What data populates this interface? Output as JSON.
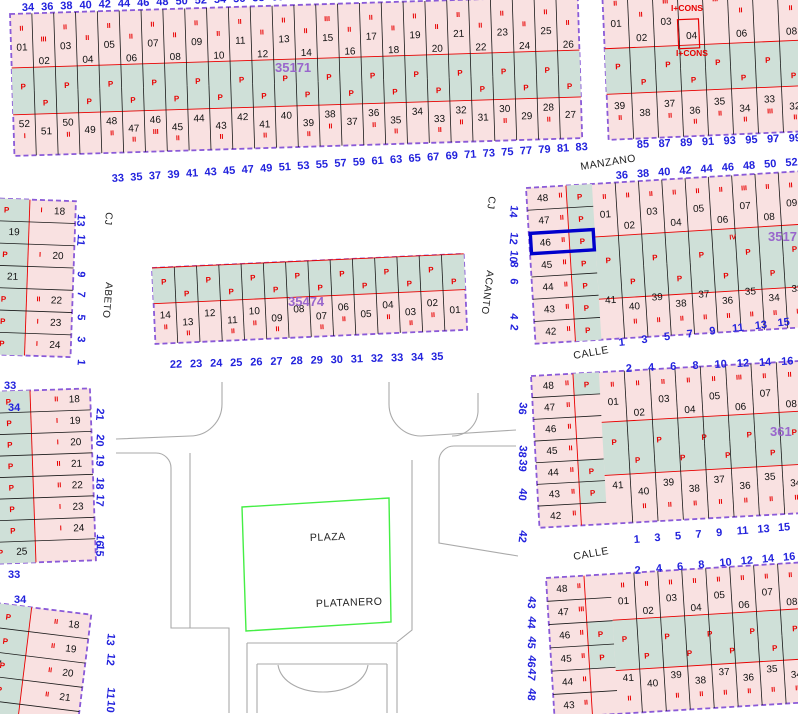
{
  "map": {
    "p_symbol": "P",
    "colors": {
      "parcel_fill": "#f9e1e1",
      "green_fill": "#cfe0d8",
      "block_border": "#8a5ad8",
      "parcel_line": "#1a1a1a",
      "red": "#e80000",
      "blue_number": "#2222dd",
      "purple_label": "#9966cc",
      "selected": "#0000cc",
      "plaza_green": "#44ee44",
      "street_gray": "#aaaaaa"
    },
    "selected_parcel": "46",
    "street_names": [
      {
        "text": "MANZANO",
        "x": 581,
        "y": 170,
        "rot": -9,
        "size": 10.5
      },
      {
        "text": "CALLE",
        "x": 574,
        "y": 359,
        "rot": -10,
        "size": 10.5
      },
      {
        "text": "CALLE",
        "x": 574,
        "y": 560,
        "rot": -10,
        "size": 10.5
      },
      {
        "text": "CJ",
        "x": 489,
        "y": 196,
        "rot": 97,
        "size": 10
      },
      {
        "text": "ACANTO",
        "x": 487,
        "y": 270,
        "rot": 97,
        "size": 10
      },
      {
        "text": "CJ",
        "x": 106,
        "y": 212,
        "rot": 95,
        "size": 10
      },
      {
        "text": "ABETO",
        "x": 106,
        "y": 282,
        "rot": 95,
        "size": 10
      },
      {
        "text": "PLAZA",
        "x": 310,
        "y": 541,
        "rot": -2,
        "size": 10.5
      },
      {
        "text": "PLATANERO",
        "x": 316,
        "y": 607,
        "rot": -2,
        "size": 10.5
      }
    ],
    "block_labels": [
      {
        "text": "35171",
        "x": 275,
        "y": 72
      },
      {
        "text": "35474",
        "x": 288,
        "y": 306
      },
      {
        "text": "3517",
        "x": 768,
        "y": 241
      },
      {
        "text": "361",
        "x": 770,
        "y": 436
      }
    ],
    "red_labels": [
      {
        "text": "I+CONS",
        "x": 671,
        "y": 11
      },
      {
        "text": "I+CONS",
        "x": 676,
        "y": 56
      }
    ],
    "stray_numbers": [
      {
        "t": "33",
        "x": 4,
        "y": 389
      },
      {
        "t": "34",
        "x": 8,
        "y": 411
      },
      {
        "t": "33",
        "x": 8,
        "y": 578
      },
      {
        "t": "34",
        "x": 14,
        "y": 603
      }
    ],
    "street_numbers": [
      {
        "id": "manzano-a-top",
        "vals": [
          "34",
          "36",
          "38",
          "40",
          "42",
          "44",
          "46",
          "48",
          "50",
          "52",
          "54",
          "56",
          "58",
          "60",
          "62"
        ],
        "x": 22,
        "y": 11,
        "dx": 19.2,
        "dy": -0.8,
        "rot": -2
      },
      {
        "id": "manzano-a-bottom",
        "vals": [
          "33",
          "35",
          "37",
          "39",
          "41",
          "43",
          "45",
          "47",
          "49",
          "51",
          "53",
          "55",
          "57",
          "59",
          "61",
          "63",
          "65",
          "67",
          "69",
          "71",
          "73",
          "75",
          "77",
          "79",
          "81",
          "83"
        ],
        "x": 112,
        "y": 182,
        "dx": 18.55,
        "dy": -1.25,
        "rot": -4
      },
      {
        "id": "manzano-b-bottom",
        "vals": [
          "85",
          "87",
          "89",
          "91",
          "93",
          "95",
          "97",
          "99"
        ],
        "x": 637,
        "y": 148,
        "dx": 21.7,
        "dy": -0.9,
        "rot": -3
      },
      {
        "id": "manzano-c-top",
        "vals": [
          "36",
          "38",
          "40",
          "42",
          "44",
          "46",
          "48",
          "50",
          "52"
        ],
        "x": 616,
        "y": 179,
        "dx": 21.2,
        "dy": -1.6,
        "rot": -4
      },
      {
        "id": "calle-c-bottom",
        "vals": [
          "1",
          "3",
          "5",
          "7",
          "9",
          "11",
          "13",
          "15"
        ],
        "x": 619,
        "y": 346,
        "dx": 22.7,
        "dy": -2.8,
        "rot": -6
      },
      {
        "id": "e-bottom",
        "vals": [
          "22",
          "23",
          "24",
          "25",
          "26",
          "27",
          "28",
          "29",
          "30",
          "31",
          "32",
          "33",
          "34",
          "35"
        ],
        "x": 170,
        "y": 368,
        "dx": 20.1,
        "dy": -0.6,
        "rot": -2
      },
      {
        "id": "acanto-vertical",
        "vals": [
          "14",
          "12",
          "10",
          "8",
          "6",
          "4",
          "2"
        ],
        "x": 511,
        "y": 205,
        "dys": [
          0,
          27,
          45,
          56,
          73,
          108,
          119
        ],
        "rot": 97
      },
      {
        "id": "abeto-vertical",
        "vals": [
          "13",
          "11",
          "9",
          "7",
          "5",
          "3",
          "1"
        ],
        "x": 78,
        "y": 214,
        "dys": [
          0,
          20,
          57,
          77,
          100,
          122,
          145
        ],
        "rot": 95
      },
      {
        "id": "f-right-vertical",
        "vals": [
          "21",
          "20",
          "19",
          "18",
          "17",
          "16",
          "15"
        ],
        "x": 97,
        "y": 408,
        "dys": [
          0,
          26,
          46,
          69,
          86,
          126,
          136
        ],
        "rot": 95
      },
      {
        "id": "g-right-vertical",
        "vals": [
          "13",
          "12",
          "11",
          "10"
        ],
        "x": 108,
        "y": 633,
        "dys": [
          0,
          20,
          54,
          67
        ],
        "rot": 97
      },
      {
        "id": "h-left-vertical",
        "vals": [
          "36",
          "38",
          "39",
          "40",
          "42"
        ],
        "x": 520,
        "y": 402,
        "dys": [
          0,
          43,
          57,
          86,
          128
        ],
        "rot": 97
      },
      {
        "id": "h-top",
        "vals": [
          "2",
          "4",
          "6",
          "8",
          "10",
          "12",
          "14",
          "16"
        ],
        "x": 626,
        "y": 372,
        "dx": 22.2,
        "dy": -1.0,
        "rot": -3
      },
      {
        "id": "h-bottom",
        "vals": [
          "1",
          "3",
          "5",
          "7",
          "9",
          "11",
          "13",
          "15"
        ],
        "x": 634,
        "y": 543,
        "dx": 20.6,
        "dy": -1.7,
        "rot": -4
      },
      {
        "id": "i-top",
        "vals": [
          "2",
          "4",
          "6",
          "8",
          "10",
          "12",
          "14",
          "16"
        ],
        "x": 635,
        "y": 574,
        "dx": 21.2,
        "dy": -1.9,
        "rot": -5
      },
      {
        "id": "i-left-vertical",
        "vals": [
          "43",
          "44",
          "45",
          "46",
          "47",
          "48"
        ],
        "x": 529,
        "y": 596,
        "dys": [
          0,
          20,
          40,
          59,
          72,
          92
        ],
        "rot": 97
      }
    ],
    "blocks": [
      {
        "id": "35171",
        "type": "h2",
        "x": 10,
        "y": 14,
        "w": 568,
        "h": 142,
        "rot": -1.8,
        "bandY": 0.38,
        "bandH": 0.33,
        "p_count": 26,
        "top": [
          "01",
          "02",
          "03",
          "04",
          "05",
          "06",
          "07",
          "08",
          "09",
          "10",
          "11",
          "12",
          "13",
          "14",
          "15",
          "16",
          "17",
          "18",
          "19",
          "20",
          "21",
          "22",
          "23",
          "24",
          "25",
          "26"
        ],
        "bottom": [
          "52",
          "51",
          "50",
          "49",
          "48",
          "47",
          "46",
          "45",
          "44",
          "43",
          "42",
          "41",
          "40",
          "39",
          "38",
          "37",
          "36",
          "35",
          "34",
          "33",
          "32",
          "31",
          "30",
          "29",
          "28",
          "27"
        ],
        "marks_top": [
          "II",
          "III",
          "II",
          "II",
          "II",
          "II",
          "II",
          "II",
          "II",
          "II",
          "II",
          "II",
          "II",
          "II",
          "III",
          "II",
          "II",
          "II",
          "II",
          "II",
          "II",
          "II",
          "II",
          "II",
          "II",
          "II"
        ],
        "marks_bottom": [
          "I",
          "",
          "II",
          "",
          "II",
          "II",
          "III",
          "II",
          "",
          "II",
          "",
          "II",
          "",
          "II",
          "II",
          "",
          "II",
          "II",
          "",
          "II",
          "II",
          "",
          "II",
          "",
          "II",
          ""
        ]
      },
      {
        "id": "manzano-north",
        "type": "h2",
        "x": 602,
        "y": -12,
        "w": 200,
        "h": 152,
        "rot": -2.5,
        "bandY": 0.4,
        "bandH": 0.3,
        "p_count": 8,
        "top": [
          "01",
          "02",
          "03",
          "04",
          "",
          "06",
          "",
          "08"
        ],
        "bottom": [
          "39",
          "38",
          "37",
          "36",
          "35",
          "34",
          "33",
          "32"
        ],
        "marks_top": [
          "II",
          "II",
          "III",
          "",
          "III",
          "II",
          "",
          "II"
        ],
        "marks_bottom": [
          "II",
          "",
          "II",
          "II",
          "II",
          "II",
          "III",
          "II"
        ],
        "red_box": [
          74,
          35,
          21,
          29
        ]
      },
      {
        "id": "3517",
        "type": "corner",
        "x": 526,
        "y": 188,
        "w": 276,
        "h": 156,
        "rot": -3.5,
        "leftW": 40,
        "greenColW": 26,
        "strip": "full",
        "selected_left": 2,
        "bandY": 0.34,
        "bandH": 0.4,
        "p_count": 9,
        "left": [
          "48",
          "47",
          "46",
          "45",
          "44",
          "43",
          "42"
        ],
        "top": [
          "01",
          "02",
          "03",
          "04",
          "05",
          "06",
          "07",
          "08",
          "09"
        ],
        "bottom": [
          "41",
          "40",
          "39",
          "38",
          "37",
          "36",
          "35",
          "34",
          "33"
        ],
        "marks_left": [
          "II",
          "II",
          "II",
          "II",
          "II",
          "II",
          "II"
        ],
        "marks_top": [
          "II",
          "II",
          "II",
          "II",
          "II",
          "II",
          "III",
          "II",
          "II"
        ],
        "marks_bottom": [
          "",
          "II",
          "II",
          "II",
          "II",
          "II",
          "II",
          "II",
          "II"
        ],
        "extra_marks": [
          {
            "t": "IV",
            "x": 200,
            "y": 64
          }
        ]
      },
      {
        "id": "35474",
        "type": "h1",
        "x": 152,
        "y": 268,
        "w": 312,
        "h": 76,
        "rot": -2.6,
        "bandY": 0,
        "bandH": 0.47,
        "p_count": 14,
        "bottom": [
          "14",
          "13",
          "12",
          "11",
          "10",
          "09",
          "08",
          "07",
          "06",
          "05",
          "04",
          "03",
          "02",
          "01"
        ],
        "marks_bottom": [
          "II",
          "II",
          "",
          "II",
          "II",
          "II",
          "",
          "II",
          "II",
          "",
          "II",
          "II",
          "II",
          ""
        ]
      },
      {
        "id": "abeto-east",
        "type": "v",
        "x": -16,
        "y": 198,
        "w": 92,
        "h": 156,
        "rot": 2,
        "greenW": 46,
        "rows": [
          "18",
          "19",
          "20",
          "21",
          "22",
          "23",
          "24"
        ],
        "left_idx": [
          1,
          3
        ],
        "marks": [
          "I",
          "I",
          "I",
          "I",
          "II",
          "I",
          "I"
        ]
      },
      {
        "id": "plaza-west",
        "type": "v",
        "x": -14,
        "y": 392,
        "w": 104,
        "h": 172,
        "rot": -2,
        "greenW": 44,
        "rows": [
          "18",
          "19",
          "20",
          "21",
          "22",
          "23",
          "24",
          "25"
        ],
        "left_idx": [
          7
        ],
        "marks": [
          "II",
          "I",
          "I",
          "II",
          "II",
          "I",
          "I",
          ""
        ]
      },
      {
        "id": "plaza-southwest",
        "type": "v",
        "x": -12,
        "y": 602,
        "w": 104,
        "h": 122,
        "rot": 7,
        "greenW": 44,
        "rows": [
          "18",
          "19",
          "20",
          "21",
          "22"
        ],
        "left_idx": [],
        "left_labels": [
          {
            "t": "17",
            "row": 2
          }
        ],
        "marks": [
          "II",
          "II",
          "II",
          "II",
          "II"
        ]
      },
      {
        "id": "361",
        "type": "corner",
        "x": 531,
        "y": 376,
        "w": 271,
        "h": 152,
        "rot": -3.2,
        "leftW": 42,
        "greenColW": 26,
        "strip_rows": [
          0,
          4,
          5
        ],
        "bandY": 0.33,
        "bandH": 0.35,
        "p_count": 9,
        "left": [
          "48",
          "47",
          "46",
          "45",
          "44",
          "43",
          "42"
        ],
        "top": [
          "01",
          "02",
          "03",
          "04",
          "05",
          "06",
          "07",
          "08"
        ],
        "bottom": [
          "41",
          "40",
          "39",
          "38",
          "37",
          "36",
          "35",
          "34"
        ],
        "marks_left": [
          "II",
          "II",
          "II",
          "II",
          "II",
          "II",
          "II"
        ],
        "marks_top": [
          "II",
          "II",
          "II",
          "II",
          "II",
          "III",
          "II",
          "II"
        ],
        "marks_bottom": [
          "",
          "II",
          "II",
          "II",
          "II",
          "II",
          "II",
          "II"
        ]
      },
      {
        "id": "calle-south",
        "type": "corner",
        "x": 546,
        "y": 578,
        "w": 256,
        "h": 140,
        "rot": -3.5,
        "leftW": 38,
        "greenColW": 26,
        "strip_rows": [
          2,
          3
        ],
        "bandY": 0.33,
        "bandH": 0.36,
        "p_count": 9,
        "left": [
          "48",
          "47",
          "46",
          "45",
          "44",
          "43"
        ],
        "top": [
          "01",
          "02",
          "03",
          "04",
          "05",
          "06",
          "07",
          "08"
        ],
        "bottom": [
          "41",
          "40",
          "39",
          "38",
          "37",
          "36",
          "35",
          "34"
        ],
        "marks_left": [
          "II",
          "III",
          "II",
          "II",
          "II",
          "II"
        ],
        "marks_top": [
          "II",
          "II",
          "II",
          "II",
          "II",
          "II",
          "II",
          "II"
        ],
        "marks_bottom": [
          "II",
          "",
          "II",
          "II",
          "II",
          "II",
          "II",
          "II"
        ]
      }
    ],
    "plaza": {
      "points": "242,507 389,498 391,622 246,631"
    },
    "street_paths": [
      "M222,382 V404 A32,32 0 0 1 190,436 L116,439",
      "M116,453 H156 A15,15 0 0 1 171,468 V628 H229 V713",
      "M190,453 V628",
      "M389,382 V404 A32,32 0 0 0 421,436 L516,430",
      "M478,393 V412 A26,26 0 0 1 452,436",
      "M516,446 H454 A15,15 0 0 0 439,461 V543 L518,556",
      "M412,460 V630 L397,642",
      "M247,643 H397 M247,643 V713 M397,643 V713",
      "M257,664 H387 M257,664 V713 M387,664 V713",
      "M278,665 C284,701 362,701 368,665"
    ]
  }
}
